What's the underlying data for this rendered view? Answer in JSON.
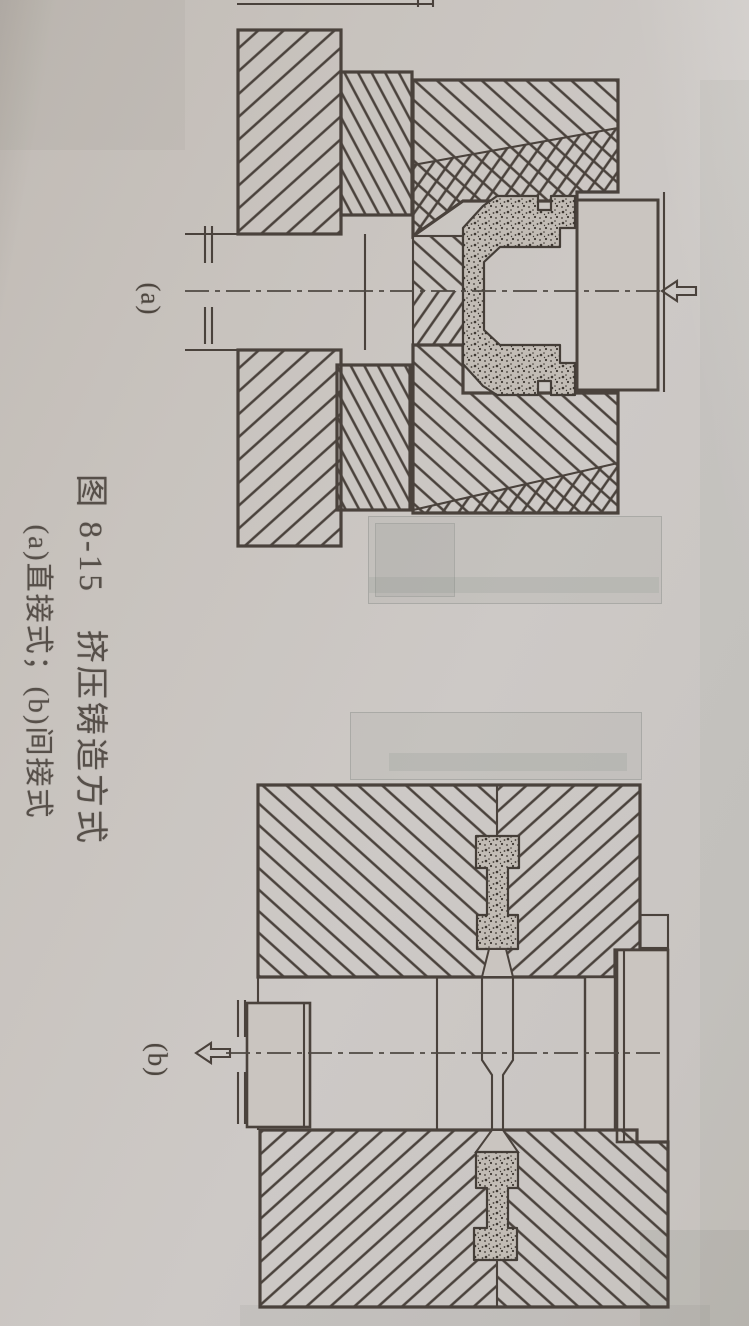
{
  "figure": {
    "caption_line1": "图 8-15　挤压铸造方式",
    "caption_line2": "(a)直接式；(b)间接式",
    "label_a": "(a)",
    "label_b": "(b)"
  },
  "colors": {
    "paper": "#cac5c0",
    "ink": "#4a423c",
    "stipple": "#3e3832",
    "bleed": "#7d847f"
  }
}
